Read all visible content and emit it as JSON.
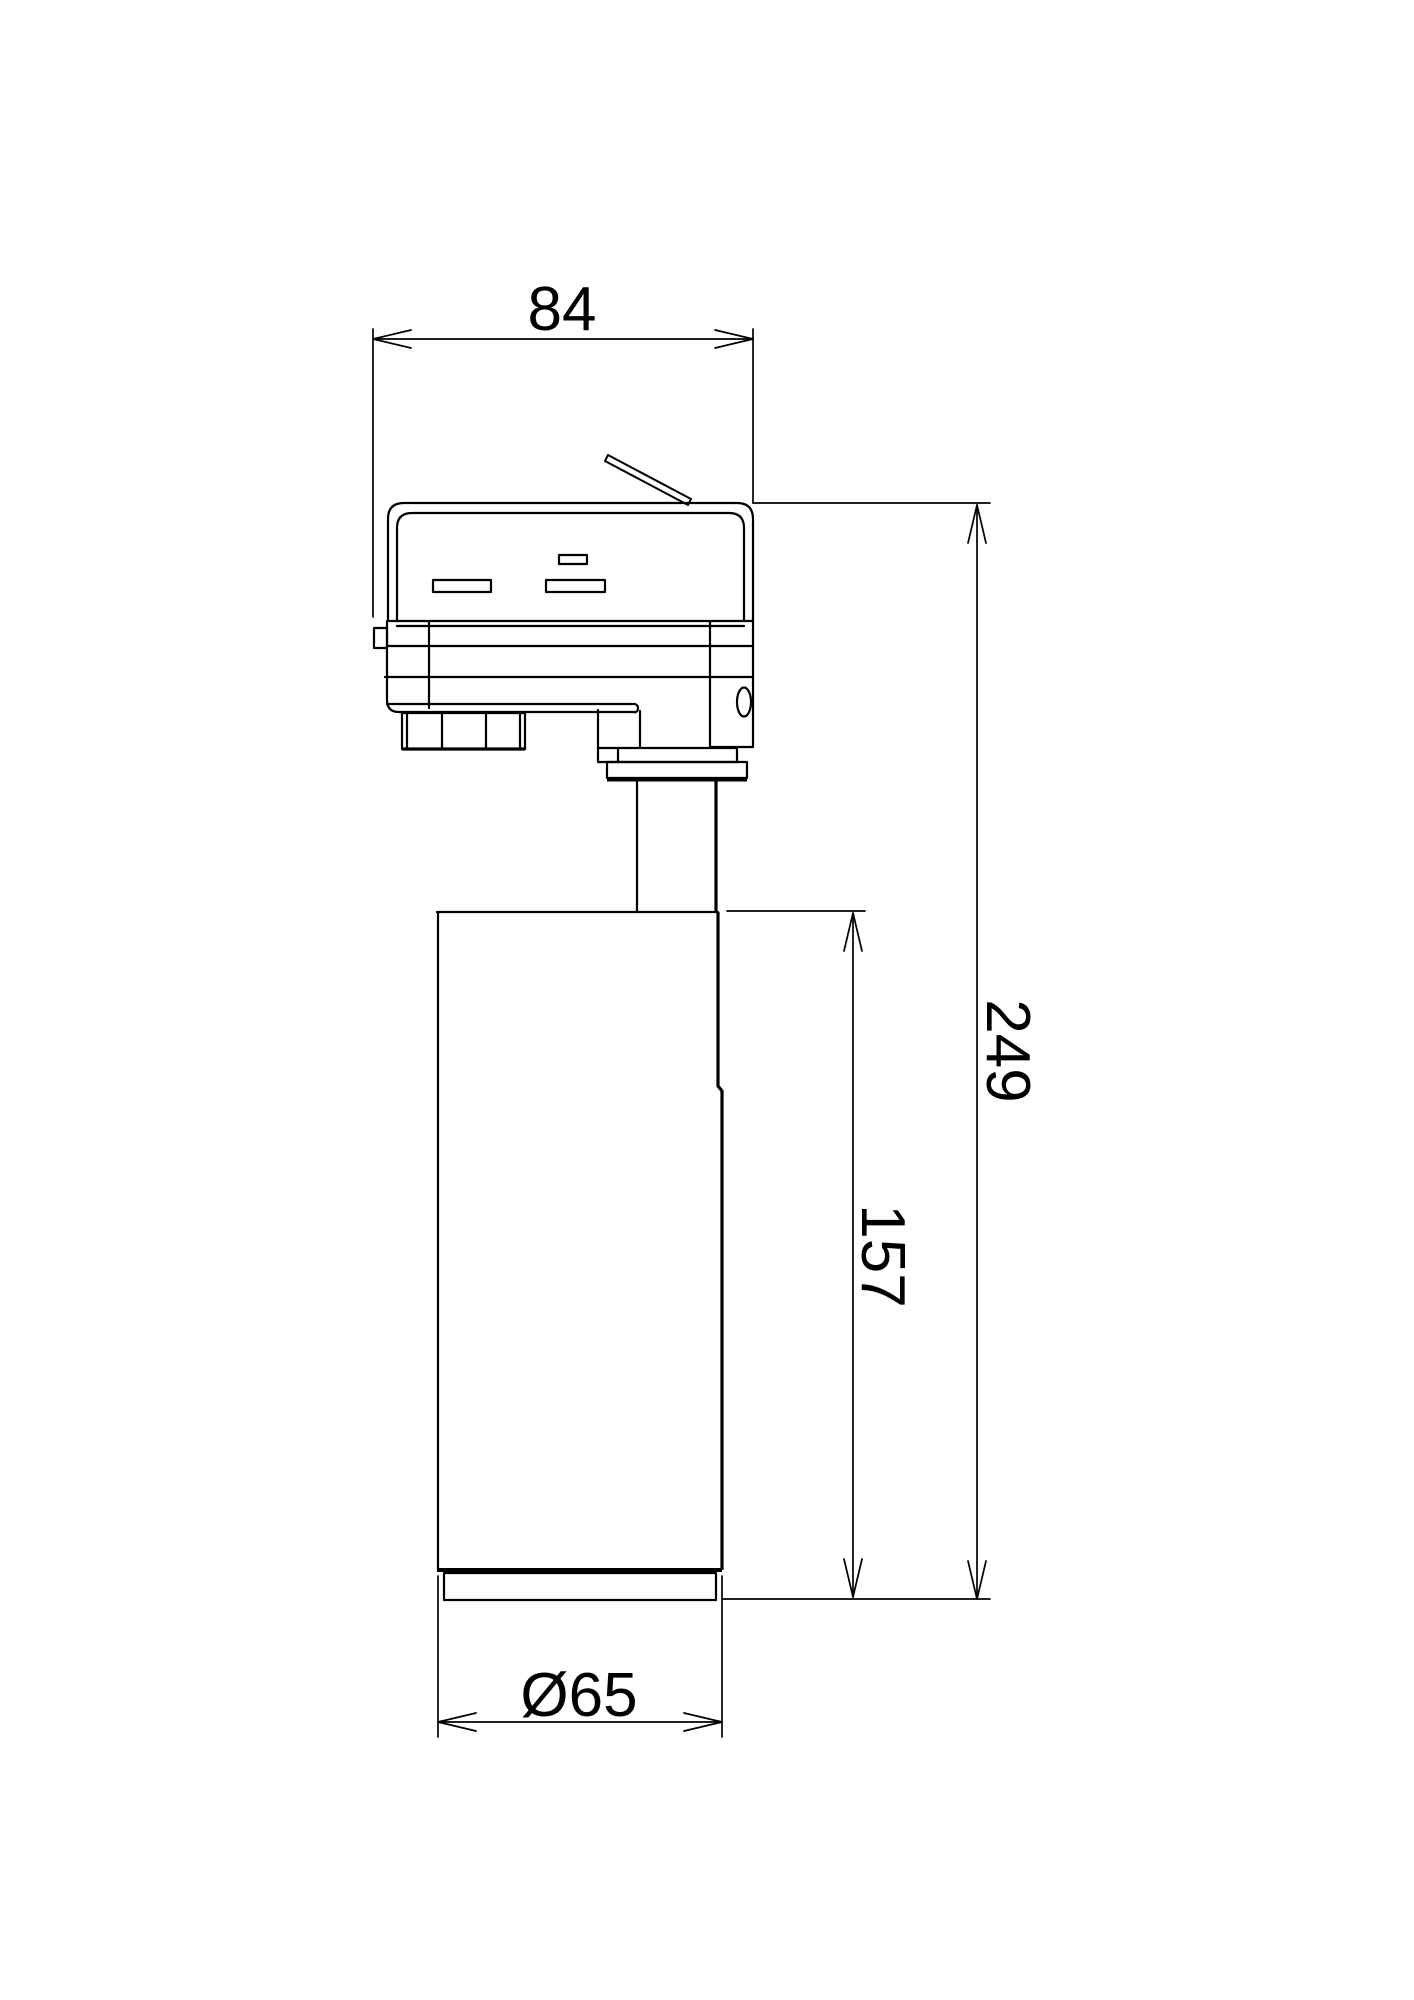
{
  "page": {
    "background_color": "#ffffff",
    "line_color": "#000000"
  },
  "drawing": {
    "type": "technical-dimension-drawing",
    "subject": "track-mounted spotlight side view",
    "dimensions": {
      "adapter_width": "84",
      "overall_height": "249",
      "body_height": "157",
      "body_diameter": "Ø65"
    }
  }
}
